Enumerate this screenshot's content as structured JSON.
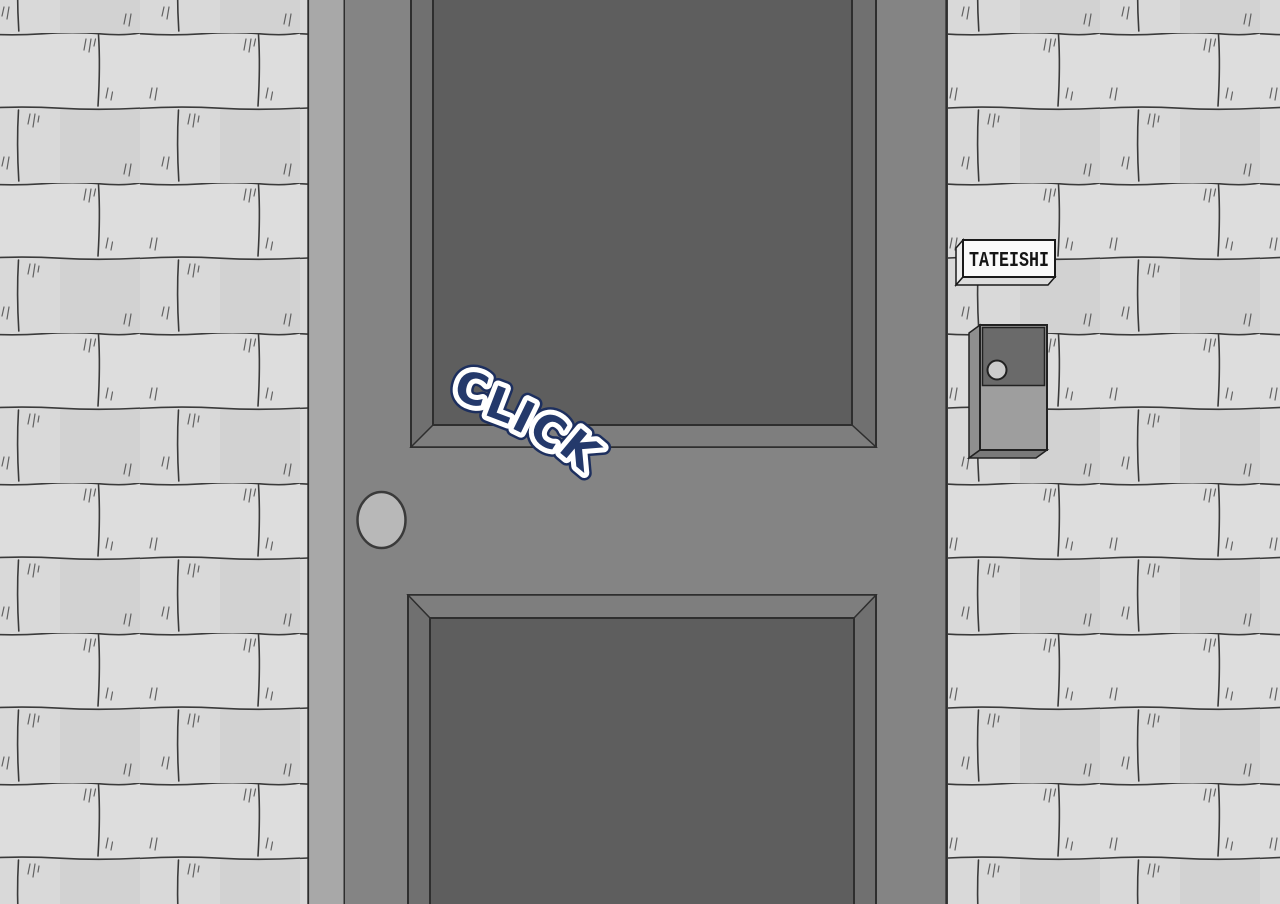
{
  "nameplate": {
    "text": "TATEISHI"
  },
  "sfx": {
    "text": "CLICK"
  },
  "colors": {
    "brick": "#d9d9d9",
    "mortar": "#3a3a3a",
    "jamb": "#a8a8a8",
    "door_face": "#848484",
    "bevel_side": "#707070",
    "bevel_lit": "#7e7e7e",
    "panel": "#5e5e5e",
    "outline": "#2e2e2e",
    "knob_fill": "#b8b8b8",
    "knob_edge": "#3a3a3a",
    "plate_bg": "#fafafa",
    "plate_side": "#ececec",
    "plate_bottom": "#dcdcdc",
    "plate_edge": "#1a1a1a",
    "plate_text": "#151515",
    "bell_body": "#9e9e9e",
    "bell_top": "#6a6a6a",
    "bell_side": "#8f8f8f",
    "bell_bottom": "#7a7a7a",
    "bell_button": "#cccccc",
    "bell_edge": "#222222",
    "sfx_fill": "#24396b",
    "sfx_stroke": "#ffffff",
    "sfx_rim": "#1d2f5e"
  }
}
